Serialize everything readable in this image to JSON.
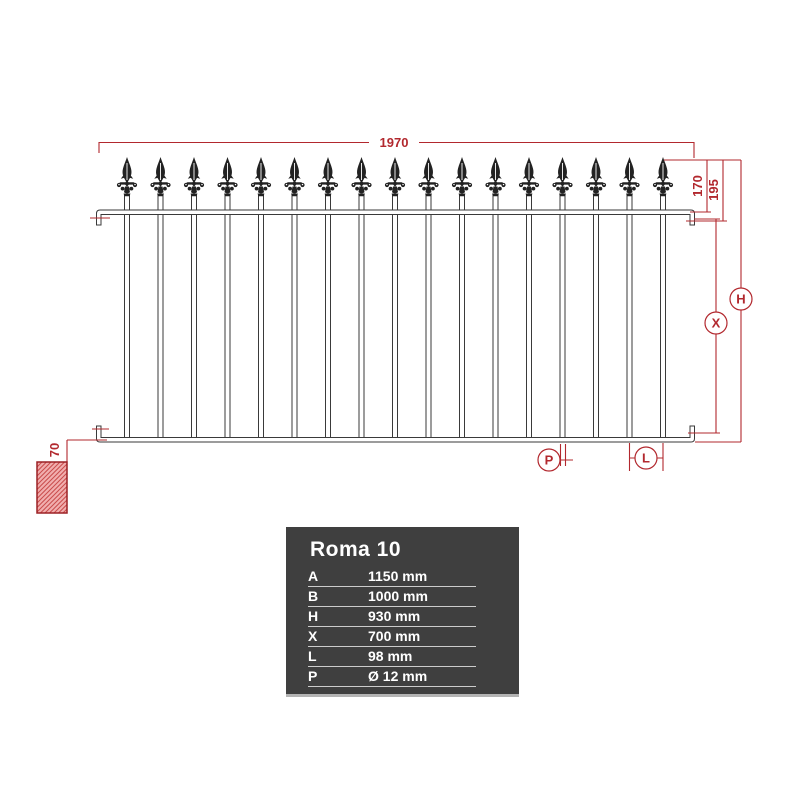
{
  "diagram_title": "Roma 10 fence panel dimensional drawing",
  "colors": {
    "dimension_red": "#b2282e",
    "fence_line": "#3a3a3a",
    "table_background": "#3f3f3f",
    "table_text": "#ffffff",
    "table_rule": "#cccccc",
    "wall_hatch_line": "#c94b4b",
    "wall_hatch_background": "#f1aeae",
    "wall_border": "#9c2025"
  },
  "fence": {
    "bars_count": 17,
    "finial_icon": "spear-finial"
  },
  "dimensions": {
    "panel_width": "1970",
    "finial_to_rail": "170",
    "finial_to_hook": "195",
    "ground_clearance": "70",
    "refs": {
      "height": "H",
      "inner_height": "X",
      "bar_diameter": "P",
      "bar_spacing": "L"
    }
  },
  "spec_table": {
    "title": "Roma 10",
    "rows": [
      {
        "key": "A",
        "value": "1150 mm"
      },
      {
        "key": "B",
        "value": "1000 mm"
      },
      {
        "key": "H",
        "value": "930 mm"
      },
      {
        "key": "X",
        "value": "700 mm"
      },
      {
        "key": "L",
        "value": "98 mm"
      },
      {
        "key": "P",
        "value": "Ø 12 mm"
      }
    ]
  }
}
